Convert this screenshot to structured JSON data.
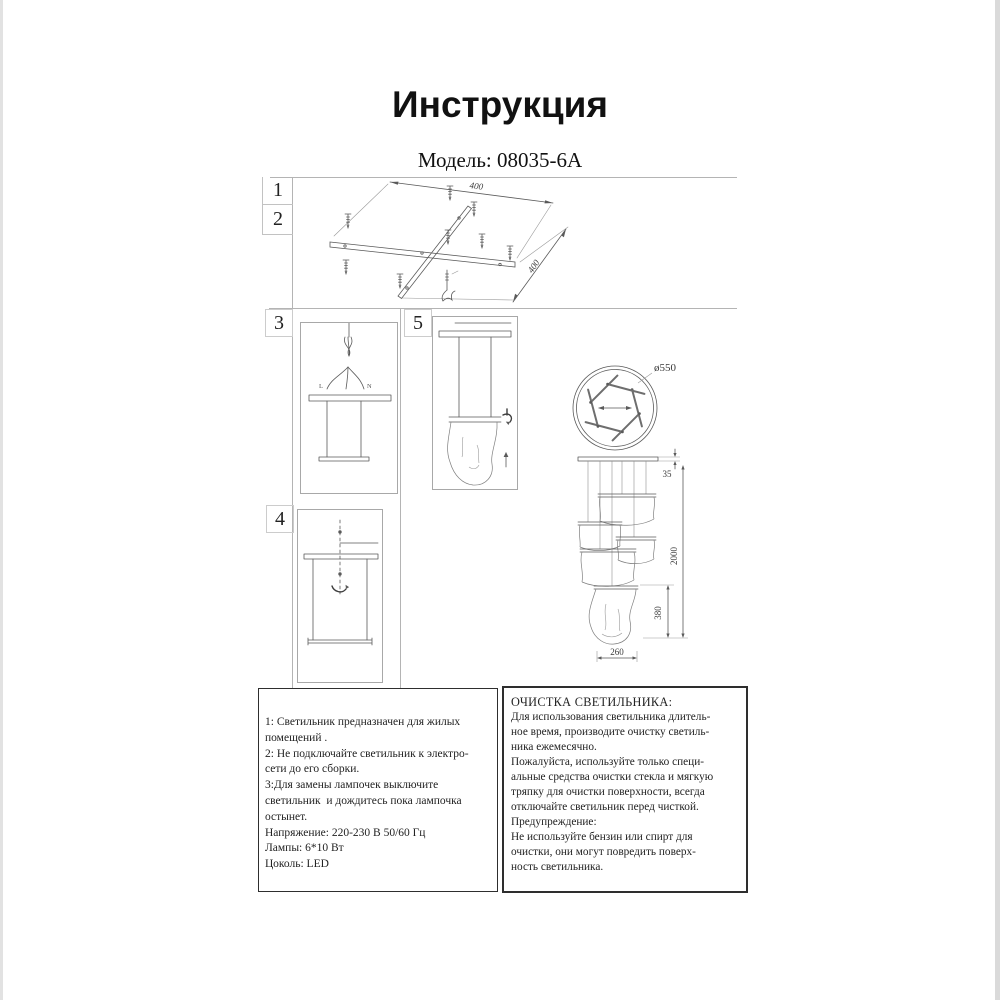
{
  "page": {
    "title": "Инструкция",
    "model": "Модель: 08035-6A"
  },
  "steps": {
    "n1": "1",
    "n2": "2",
    "n3": "3",
    "n4": "4",
    "n5": "5"
  },
  "dims": {
    "plate_width": "400",
    "plate_depth": "400",
    "diameter": "ø550",
    "canopy_height": "35",
    "overall_height": "2000",
    "shade_height": "380",
    "shade_width": "260"
  },
  "wiring": {
    "live": "L",
    "neutral": "N"
  },
  "notes": {
    "lines": [
      "1: Светильник предназначен для жилых",
      "помещений .",
      "2: Не подключайте светильник к электро-",
      "сети до его сборки.",
      "3:Для замены лампочек выключите",
      "светильник  и дождитесь пока лампочка",
      "остынет.",
      "Напряжение: 220-230 В 50/60 Гц",
      "Лампы: 6*10 Вт",
      "Цоколь: LED"
    ]
  },
  "cleaning": {
    "title": "ОЧИСТКА СВЕТИЛЬНИКА:",
    "lines": [
      "Для использования светильника длитель-",
      "ное время, производите очистку светиль-",
      "ника ежемесячно.",
      "Пожалуйста, используйте только специ-",
      "альные средства очистки стекла и мягкую",
      "тряпку для очистки поверхности, всегда",
      "отключайте светильник перед чисткой.",
      "Предупреждение:",
      "Не используйте бензин или спирт для",
      "очистки, они могут повредить поверх-",
      "ность светильника."
    ]
  }
}
